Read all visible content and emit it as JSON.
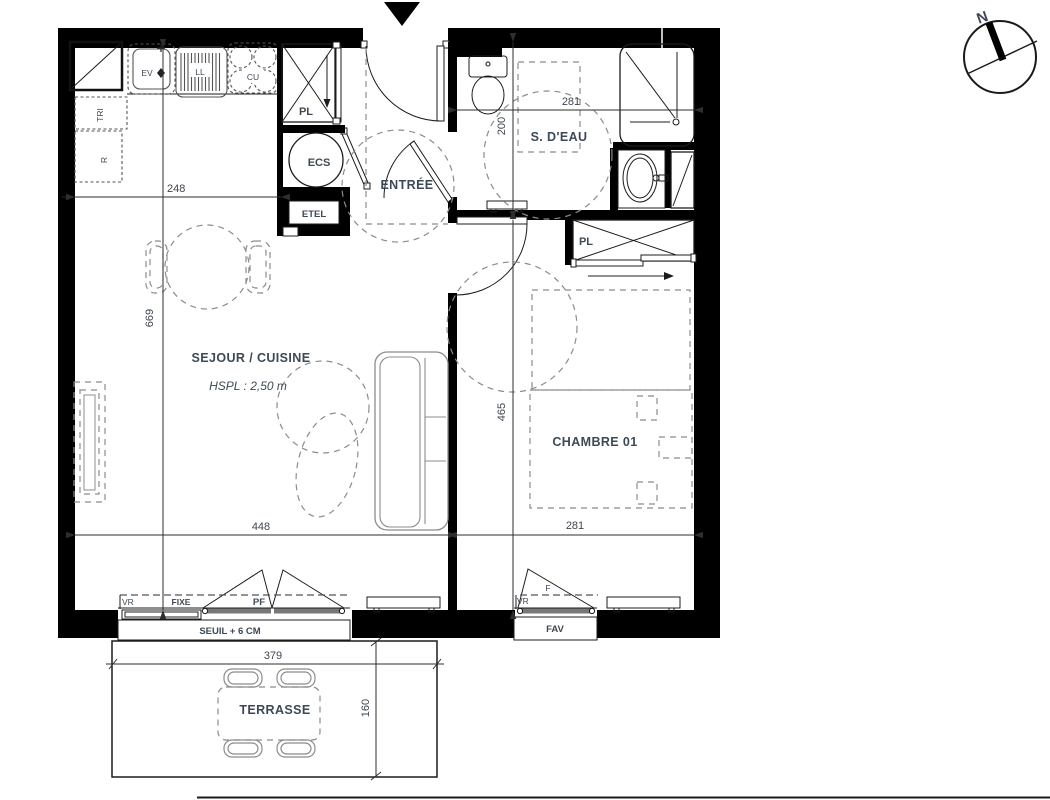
{
  "colors": {
    "wall": "#000000",
    "line": "#1c1c1c",
    "label": "#3d4956",
    "furniture_dash": "#8c8c8c",
    "window_gray": "#787878"
  },
  "compass": {
    "north_label": "N"
  },
  "rooms": {
    "sejour_cuisine": {
      "name": "SEJOUR / CUISINE",
      "ceiling_height": "HSPL : 2,50 m"
    },
    "chambre_01": {
      "name": "CHAMBRE 01"
    },
    "salle_eau": {
      "name": "S. D'EAU"
    },
    "entree": {
      "name": "ENTRÉE"
    },
    "terrasse": {
      "name": "TERRASSE"
    }
  },
  "fixtures": {
    "sink": "EV",
    "washing_machine": "LL",
    "hob": "CU",
    "recycling": "TRI",
    "fridge": "R",
    "closet_hall": "PL",
    "water_heater": "ECS",
    "electrical_panel": "ETEL",
    "closet_bedroom": "PL"
  },
  "windows": {
    "roller_shutter_sejour": "VR",
    "fixed_panel": "FIXE",
    "french_window": "PF",
    "threshold": "SEUIL + 6 CM",
    "roller_shutter_chambre": "VR",
    "casement": "F",
    "window_chambre_sill": "FAV"
  },
  "dimensions_cm": {
    "kitchen_width": "248",
    "sejour_length": "669",
    "sejour_width": "448",
    "sdeau_width": "281",
    "sdeau_depth": "200",
    "chambre_length": "465",
    "chambre_width": "281",
    "terrasse_width": "379",
    "terrasse_depth": "160"
  }
}
